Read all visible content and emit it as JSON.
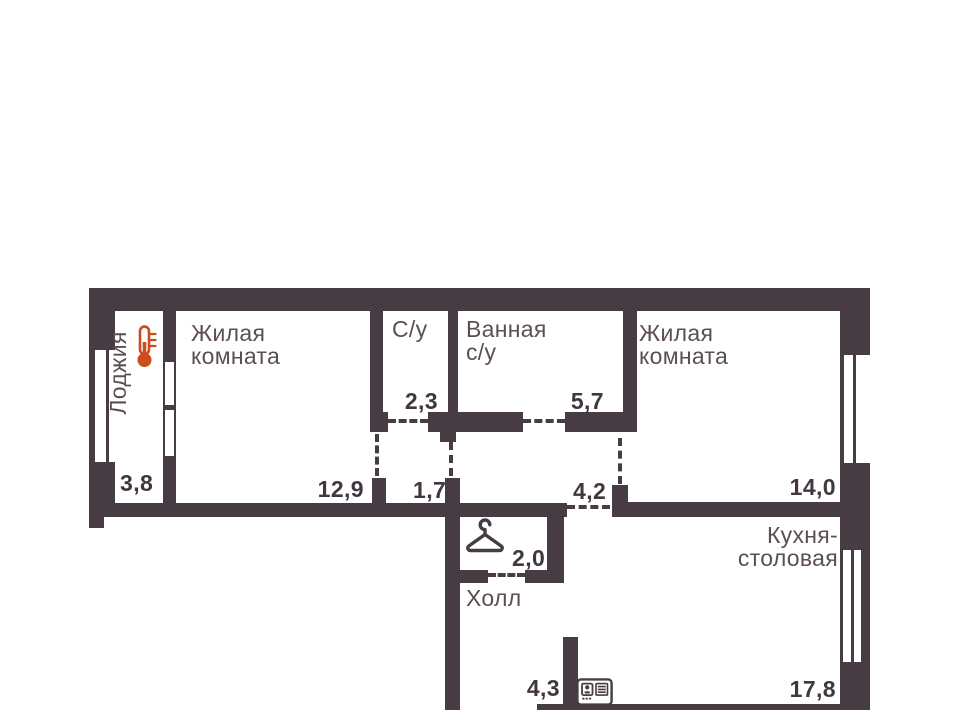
{
  "floorplan": {
    "type": "apartment-floor-plan",
    "rooms": {
      "loggia": {
        "name": "Лоджия",
        "area": "3,8"
      },
      "living_left": {
        "name": "Жилая\nкомната",
        "area": "12,9"
      },
      "wc": {
        "name": "С/у",
        "area": "2,3"
      },
      "bathroom": {
        "name": "Ванная\nс/у",
        "area": "5,7"
      },
      "living_right": {
        "name": "Жилая\nкомната",
        "area": "14,0"
      },
      "kitchen": {
        "name": "Кухня-\nстоловая",
        "area": "17,8"
      },
      "hall": {
        "name": "Холл",
        "area": "4,3"
      },
      "wardrobe": {
        "area": "2,0"
      },
      "corridor_wc": {
        "area": "1,7"
      },
      "corridor_bath": {
        "area": "4,2"
      }
    },
    "icons": {
      "thermometer": "thermometer-icon",
      "hanger": "hanger-icon",
      "panel": "intercom-panel-icon"
    },
    "colors": {
      "wall": "#483c44",
      "room_label": "#5b4f55",
      "area_number": "#423640",
      "thermometer": "#cb4c1d",
      "background": "#ffffff"
    }
  }
}
